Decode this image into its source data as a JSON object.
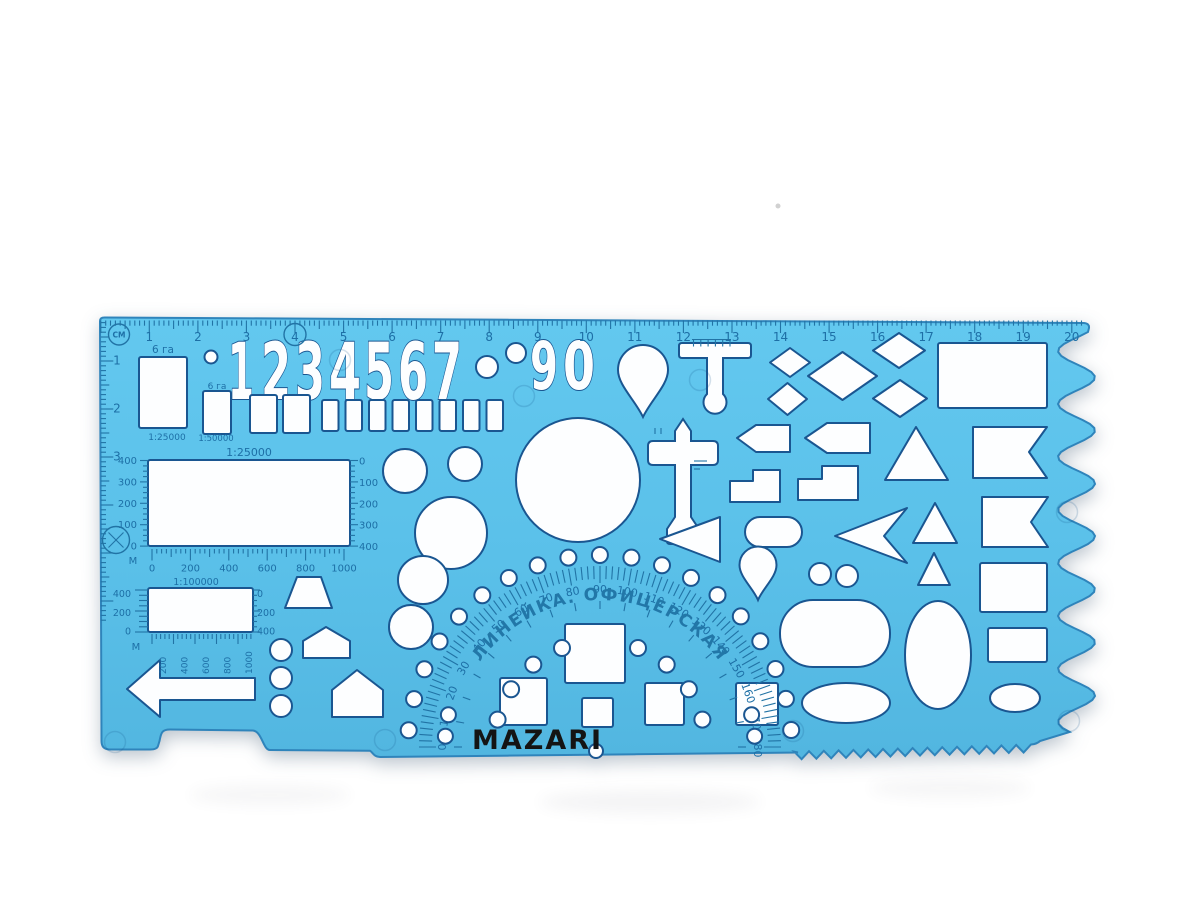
{
  "brand": {
    "name": "MAZARI"
  },
  "arc_text": "ЛИНЕЙКА.  ОФИЦЕРСКАЯ",
  "top_ruler": {
    "unit": "СМ",
    "numbers": [
      "1",
      "2",
      "3",
      "4",
      "5",
      "6",
      "7",
      "8",
      "9",
      "10",
      "11",
      "12",
      "13",
      "14",
      "15",
      "16",
      "17",
      "18",
      "19",
      "20"
    ],
    "circled_number": "4"
  },
  "left_ruler": {
    "numbers": [
      "1",
      "2",
      "3"
    ]
  },
  "area_squares": [
    {
      "label": "6 га",
      "scale": "1:25000"
    },
    {
      "label": "6 га",
      "scale": "1:50000"
    }
  ],
  "map_scales": {
    "rect1": {
      "title": "1:25000",
      "left": [
        "400",
        "300",
        "200",
        "100",
        "0"
      ],
      "right": [
        "0",
        "100",
        "200",
        "300",
        "400"
      ],
      "bottom": [
        "0",
        "200",
        "400",
        "600",
        "800",
        "1000"
      ],
      "m_label": "М",
      "bottom_title": "1:100000"
    },
    "rect2": {
      "left": [
        "400",
        "200",
        "0"
      ],
      "right": [
        "0",
        "200",
        "400"
      ],
      "bottom_rotated": [
        "200",
        "400",
        "600",
        "800",
        "1000"
      ],
      "m_label": "М"
    }
  },
  "protractor": {
    "degrees": [
      "0",
      "10",
      "20",
      "30",
      "40",
      "50",
      "60",
      "70",
      "80",
      "90",
      "100",
      "110",
      "120",
      "130",
      "140",
      "150",
      "160",
      "170",
      "180"
    ]
  },
  "colors": {
    "body_top": "#62c7ee",
    "body_bottom": "#53b7e1",
    "print": "#1d6fa6",
    "cut_stroke": "#1a5691",
    "brand_text": "#141414",
    "background": "#ffffff"
  },
  "shapes": [
    {
      "n": "digit-cutout-1",
      "t": "text",
      "str": "1",
      "x": 228,
      "y": 399,
      "s": 78,
      "tl": 26
    },
    {
      "n": "digit-cutout-2",
      "t": "text",
      "str": "2",
      "x": 261,
      "y": 399,
      "s": 78,
      "tl": 30
    },
    {
      "n": "digit-cutout-3",
      "t": "text",
      "str": "3",
      "x": 295,
      "y": 399,
      "s": 78,
      "tl": 30
    },
    {
      "n": "digit-cutout-4",
      "t": "text",
      "str": "4",
      "x": 329,
      "y": 399,
      "s": 78,
      "tl": 32
    },
    {
      "n": "digit-cutout-5",
      "t": "text",
      "str": "5",
      "x": 364,
      "y": 399,
      "s": 78,
      "tl": 30
    },
    {
      "n": "digit-cutout-6",
      "t": "text",
      "str": "6",
      "x": 398,
      "y": 399,
      "s": 78,
      "tl": 30
    },
    {
      "n": "digit-cutout-7",
      "t": "text",
      "str": "7",
      "x": 432,
      "y": 399,
      "s": 78,
      "tl": 30
    },
    {
      "n": "digit-cutout-9",
      "t": "text",
      "str": "9",
      "x": 530,
      "y": 389,
      "s": 66,
      "tl": 28
    },
    {
      "n": "digit-cutout-0",
      "t": "text",
      "str": "0",
      "x": 563,
      "y": 389,
      "s": 66,
      "tl": 32
    },
    {
      "n": "area-square-25000",
      "t": "rect",
      "x": 139,
      "y": 357,
      "w": 48,
      "h": 71
    },
    {
      "n": "area-square-50000",
      "t": "rect",
      "x": 203,
      "y": 391,
      "w": 28,
      "h": 43
    },
    {
      "n": "square-cutout",
      "t": "rect",
      "x": 250,
      "y": 395,
      "w": 27,
      "h": 38
    },
    {
      "n": "square-cutout",
      "t": "rect",
      "x": 283,
      "y": 395,
      "w": 27,
      "h": 38
    },
    {
      "n": "square-cutout",
      "t": "rect",
      "x": 322,
      "y": 400,
      "w": 16.5,
      "h": 31
    },
    {
      "n": "square-cutout",
      "t": "rect",
      "x": 345.5,
      "y": 400,
      "w": 16.5,
      "h": 31
    },
    {
      "n": "square-cutout",
      "t": "rect",
      "x": 369,
      "y": 400,
      "w": 16.5,
      "h": 31
    },
    {
      "n": "square-cutout",
      "t": "rect",
      "x": 392.5,
      "y": 400,
      "w": 16.5,
      "h": 31
    },
    {
      "n": "square-cutout",
      "t": "rect",
      "x": 416,
      "y": 400,
      "w": 16.5,
      "h": 31
    },
    {
      "n": "square-cutout",
      "t": "rect",
      "x": 439.5,
      "y": 400,
      "w": 16.5,
      "h": 31
    },
    {
      "n": "square-cutout",
      "t": "rect",
      "x": 463,
      "y": 400,
      "w": 16.5,
      "h": 31
    },
    {
      "n": "square-cutout",
      "t": "rect",
      "x": 486.5,
      "y": 400,
      "w": 16.5,
      "h": 31
    },
    {
      "n": "circle-cutout",
      "t": "circle",
      "cx": 211,
      "cy": 357,
      "r": 6.5
    },
    {
      "n": "circle-cutout",
      "t": "circle",
      "cx": 487,
      "cy": 367,
      "r": 11
    },
    {
      "n": "circle-cutout",
      "t": "circle",
      "cx": 516,
      "cy": 353,
      "r": 10
    },
    {
      "n": "map-rect-25000",
      "t": "rect",
      "x": 148,
      "y": 460,
      "w": 202,
      "h": 86
    },
    {
      "n": "map-rect-100000",
      "t": "rect",
      "x": 148,
      "y": 588,
      "w": 105,
      "h": 44
    },
    {
      "n": "circle-cutout",
      "t": "circle",
      "cx": 405,
      "cy": 471,
      "r": 22
    },
    {
      "n": "circle-cutout",
      "t": "circle",
      "cx": 465,
      "cy": 464,
      "r": 17
    },
    {
      "n": "big-circle-cutout",
      "t": "circle",
      "cx": 578,
      "cy": 480,
      "r": 62
    },
    {
      "n": "circle-cutout",
      "t": "circle",
      "cx": 451,
      "cy": 533,
      "r": 36
    },
    {
      "n": "ellipse-cutout",
      "t": "ellipse",
      "cx": 423,
      "cy": 580,
      "rx": 25,
      "ry": 24
    },
    {
      "n": "circle-cutout",
      "t": "circle",
      "cx": 411,
      "cy": 627,
      "r": 22
    },
    {
      "n": "teardrop-cutout",
      "t": "path",
      "d": "M 618,370 A 25,25 0 1 1 668,370 C 668,385 651,400 643,417 C 635,400 618,385 618,370 Z"
    },
    {
      "n": "t-symbol-cutout",
      "t": "path",
      "d": "M 682,343 L 748,343 Q 751,343 751,346 L 751,355 Q 751,358 748,358 L 723,358 L 723,394 A 11.5,11.5 0 1 1 707,394 L 707,358 L 682,358 Q 679,358 679,355 L 679,346 Q 679,343 682,343 Z"
    },
    {
      "n": "cross-symbol-cutout",
      "t": "path",
      "d": "M 683,419 L 691,431 L 691,441 L 713,441 Q 718,441 718,446 L 718,460 Q 718,465 713,465 L 691,465 L 691,517 L 699,529 L 699,541 Q 699,544 696,544 L 670,544 Q 667,544 667,541 L 667,529 L 675,517 L 675,465 L 653,465 Q 648,465 648,460 L 648,446 Q 648,441 653,441 L 675,441 L 675,431 Z"
    },
    {
      "n": "rhombus-cutout",
      "t": "poly",
      "pts": "790,348 810,362.5 790,377 770,362.5"
    },
    {
      "n": "rhombus-large-cutout",
      "t": "poly",
      "pts": "842.5,352 877,376 842.5,400 808,376"
    },
    {
      "n": "rhombus-cutout",
      "t": "poly",
      "pts": "899,333 925,350.5 899,368 873,350.5"
    },
    {
      "n": "rhombus-cutout",
      "t": "poly",
      "pts": "787.5,383 807,399 787.5,415 768,399"
    },
    {
      "n": "rhombus-cutout",
      "t": "poly",
      "pts": "900,380 927,398.5 900,417 873,398.5"
    },
    {
      "n": "rect-large-cutout",
      "t": "rect",
      "x": 938,
      "y": 343,
      "w": 109,
      "h": 65
    },
    {
      "n": "pentagon-arrow-cutout",
      "t": "poly",
      "pts": "737,438 756,425 790,425 790,452 756,452"
    },
    {
      "n": "pentagon-arrow-cutout",
      "t": "poly",
      "pts": "805,438 827,423 870,423 870,453 827,453"
    },
    {
      "n": "triangle-cutout",
      "t": "poly",
      "pts": "916,427 948,480 885,480"
    },
    {
      "n": "flag-cutout",
      "t": "poly",
      "pts": "973,427 1047,427 1029,452 1047,478 973,478"
    },
    {
      "n": "step-shape-cutout",
      "t": "poly",
      "pts": "730,481 753,481 753,470 780,470 780,502 730,502"
    },
    {
      "n": "step-shape-cutout",
      "t": "poly",
      "pts": "798,479 822,479 822,466 858,466 858,500 798,500"
    },
    {
      "n": "triangle-cutout",
      "t": "poly",
      "pts": "935,503 957,543 913,543"
    },
    {
      "n": "flag-cutout",
      "t": "poly",
      "pts": "982,497 1048,497 1031,522 1048,547 982,547"
    },
    {
      "n": "dart-arrow-cutout",
      "t": "poly",
      "pts": "835,536 907,508 884,536 907,563"
    },
    {
      "n": "stadium-cutout",
      "t": "rect",
      "x": 745,
      "y": 517,
      "w": 57,
      "h": 30,
      "rx": 15
    },
    {
      "n": "triangle-left-cutout",
      "t": "poly",
      "pts": "660,539 720,517 720,562"
    },
    {
      "n": "triangle-cutout",
      "t": "poly",
      "pts": "934,553 950,585 918,585"
    },
    {
      "n": "teardrop-cutout",
      "t": "path",
      "d": "M 739.5,565 A 18.5,18.5 0 1 1 776.5,565 C 776.5,577 763,588 758,600 C 753,588 739.5,577 739.5,565 Z"
    },
    {
      "n": "circle-cutout",
      "t": "circle",
      "cx": 820,
      "cy": 574,
      "r": 11
    },
    {
      "n": "circle-cutout",
      "t": "circle",
      "cx": 847,
      "cy": 576,
      "r": 11
    },
    {
      "n": "rect-cutout",
      "t": "rect",
      "x": 980,
      "y": 563,
      "w": 67,
      "h": 49
    },
    {
      "n": "rect-cutout",
      "t": "rect",
      "x": 988,
      "y": 628,
      "w": 59,
      "h": 34
    },
    {
      "n": "ellipse-cutout",
      "t": "ellipse",
      "cx": 1015,
      "cy": 698,
      "rx": 25,
      "ry": 14
    },
    {
      "n": "stadium-large-cutout",
      "t": "rect",
      "x": 780,
      "y": 600,
      "w": 110,
      "h": 67,
      "rx": 33
    },
    {
      "n": "ellipse-cutout",
      "t": "ellipse",
      "cx": 846,
      "cy": 703,
      "rx": 44,
      "ry": 20
    },
    {
      "n": "ellipse-vertical-cutout",
      "t": "ellipse",
      "cx": 938,
      "cy": 655,
      "rx": 33,
      "ry": 54
    },
    {
      "n": "square-cutout",
      "t": "rect",
      "x": 565,
      "y": 624,
      "w": 60,
      "h": 59
    },
    {
      "n": "square-cutout",
      "t": "rect",
      "x": 500,
      "y": 678,
      "w": 47,
      "h": 47
    },
    {
      "n": "square-cutout",
      "t": "rect",
      "x": 582,
      "y": 698,
      "w": 31,
      "h": 29
    },
    {
      "n": "square-cutout",
      "t": "rect",
      "x": 645,
      "y": 683,
      "w": 39,
      "h": 42
    },
    {
      "n": "square-cutout",
      "t": "rect",
      "x": 736,
      "y": 683,
      "w": 42,
      "h": 42
    },
    {
      "n": "trapezoid-cutout",
      "t": "poly",
      "pts": "297,577 321,577 332,608 285,608"
    },
    {
      "n": "house-pentagon-cutout",
      "t": "poly",
      "pts": "326,627 350,641 350,658 303,658 303,641"
    },
    {
      "n": "house-pentagon-cutout",
      "t": "poly",
      "pts": "357,670 383,690 383,717 332,717 332,690"
    },
    {
      "n": "circle-cutout",
      "t": "circle",
      "cx": 281,
      "cy": 650,
      "r": 11
    },
    {
      "n": "circle-cutout",
      "t": "circle",
      "cx": 281,
      "cy": 678,
      "r": 11
    },
    {
      "n": "circle-cutout",
      "t": "circle",
      "cx": 281,
      "cy": 706,
      "r": 11
    },
    {
      "n": "arrow-left-cutout",
      "t": "poly",
      "pts": "127,689 160,660 160,678 255,678 255,700 160,700 160,717"
    }
  ]
}
